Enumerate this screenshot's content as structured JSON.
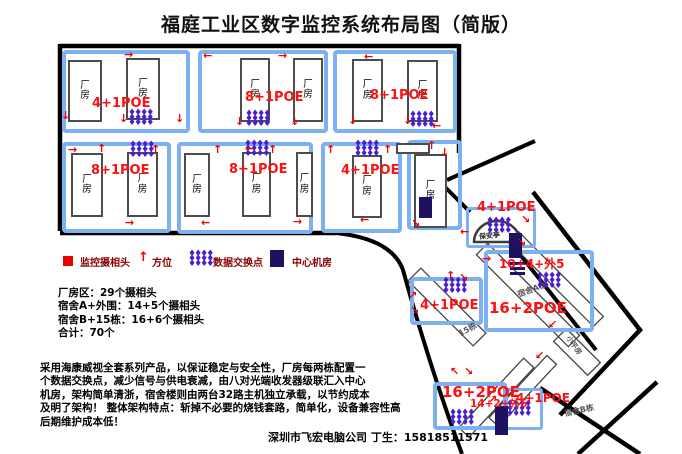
{
  "title": "福庭工业区数字监控系统布局图（简版）",
  "icons": {
    "up": "↑",
    "down": "↓",
    "left": "←",
    "right": "→",
    "up_right": "↗",
    "down_right": "↘",
    "down_left": "↙",
    "up_left": "↖",
    "switch_cluster": "♦♦♦♦\n♦♦♦♦\n♦♦♦♦",
    "camera_square": "camera-red-square",
    "server_rect": "server-navy-rect"
  },
  "legend": {
    "camera": "监控摄相头",
    "direction": "方位",
    "switch": "数据交换点",
    "server": "中心机房"
  },
  "labels": {
    "factory": "厂\n房",
    "booth": "保安亭",
    "dorm_a": "宿舍A栋",
    "dorm_b": "宿舍B栋",
    "b15": "15栋",
    "small_house": "小平房"
  },
  "poe": {
    "r1b1": "4+1POE",
    "r1b2": "8+1POE",
    "r1b3": "8+1POE",
    "r2b1": "8+1POE",
    "r2b2": "8+1POE",
    "r2b3": "4+1POE",
    "gate": "4+1POE",
    "dorm_a_top": "10+4+外5",
    "dorm_a": "16+2POE",
    "b15": "4+1POE",
    "dorm_b": "16+2POE",
    "dorm_b_mid": "14+2+外6",
    "dorm_b_right": "4+1POE"
  },
  "stats": [
    "厂房区：29个摄相头",
    "宿舍A+外围：14+5个摄相头",
    "宿舍B+15栋：16+6个摄相头",
    "合计：70个"
  ],
  "description": [
    "采用海康威视全套系列产品，以保证稳定与安全性，厂房每两栋配置一",
    "个数据交换点，减少信号与供电衰减，由八对光端收发器级联汇入中心",
    "机房，架构简单清浙，宿舍楼则由两台32路主机独立承载，以节约成本",
    "及明了架构！ 整体架构特点：斩掉不必要的烧钱套路，简单化，设备兼容性高",
    "后期维护成本低！"
  ],
  "footer": "深圳市飞宏电脑公司 丁生：15818511571",
  "colors": {
    "poe_red": "#ff1010",
    "switch_purple": "#4a1fd0",
    "server_navy": "#1e1260",
    "legend_dark_red": "#8b0000",
    "block_blue": "#7db0f0",
    "road_black": "#000000"
  }
}
